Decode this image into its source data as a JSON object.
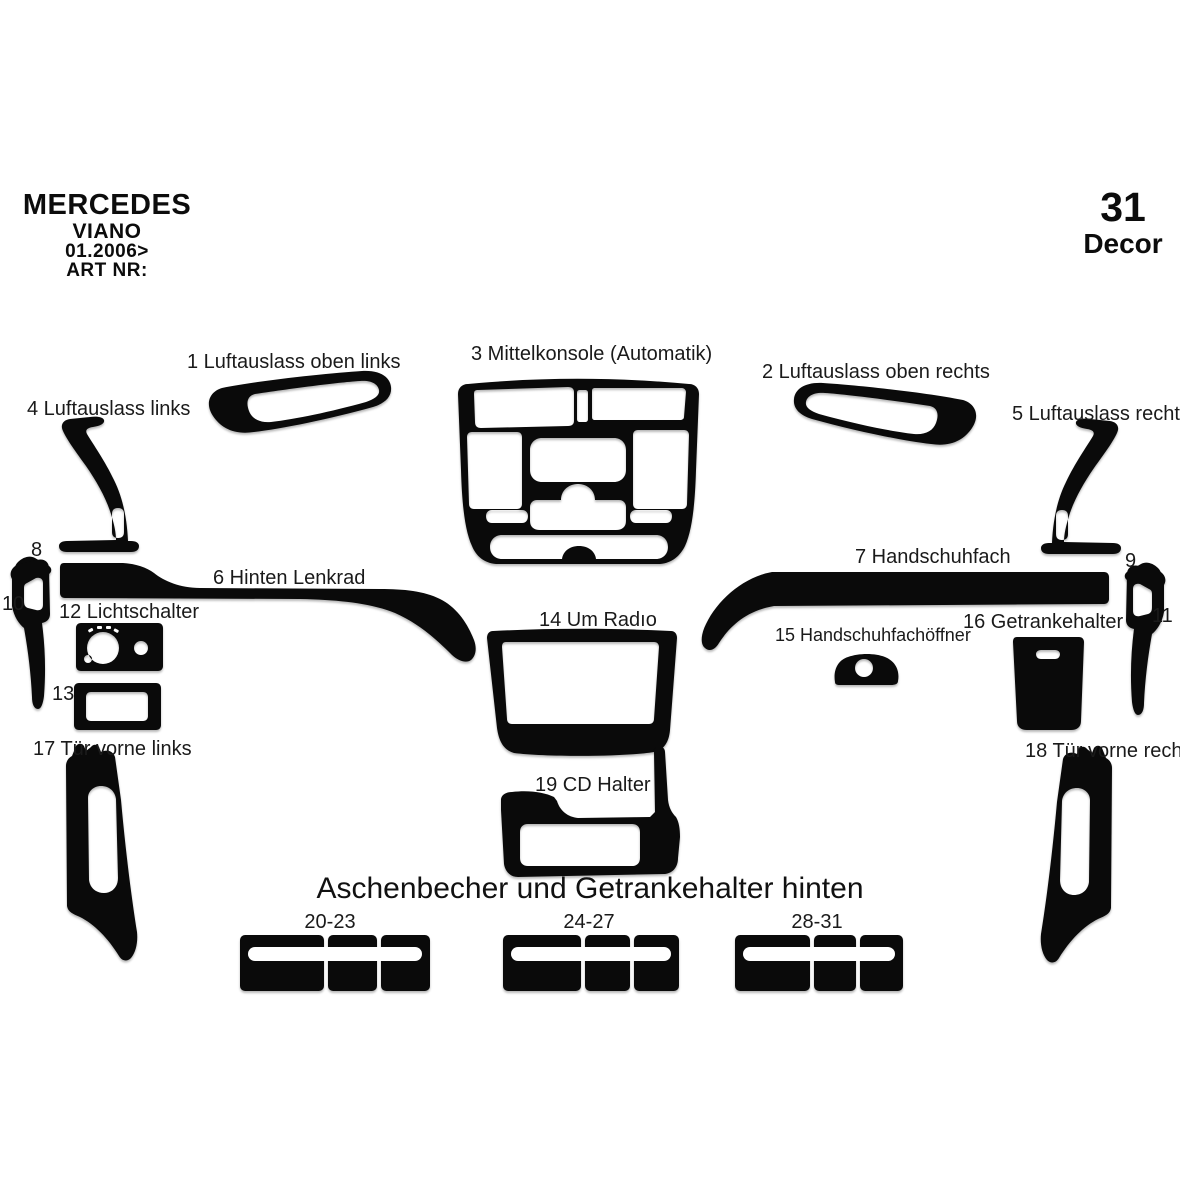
{
  "header": {
    "brand": "MERCEDES",
    "model": "VIANO",
    "year": "01.2006>",
    "art_nr": "ART NR:",
    "decor_number": "31",
    "decor_label": "Decor"
  },
  "colors": {
    "background": "#ffffff",
    "part_fill": "#0a0a0a",
    "text": "#1a1a1a"
  },
  "parts": {
    "p1": "1 Luftauslass oben links",
    "p2": "2 Luftauslass oben rechts",
    "p3": "3 Mittelkonsole (Automatik)",
    "p4": "4 Luftauslass links",
    "p5": "5 Luftauslass rechts",
    "p6": "6 Hinten Lenkrad",
    "p7": "7 Handschuhfach",
    "p8": "8",
    "p9": "9",
    "p10": "10",
    "p11": "11",
    "p12": "12 Lichtschalter",
    "p13": "13",
    "p14": "14 Um Radıo",
    "p15": "15 Handschuhfachöffner",
    "p16": "16 Getrankehalter",
    "p17": "17 Tür vorne links",
    "p18": "18 Tür vorne rechts",
    "p19": "19 CD Halter"
  },
  "bottom": {
    "heading": "Aschenbecher und Getrankehalter hinten",
    "group_labels": [
      "20-23",
      "24-27",
      "28-31"
    ]
  }
}
